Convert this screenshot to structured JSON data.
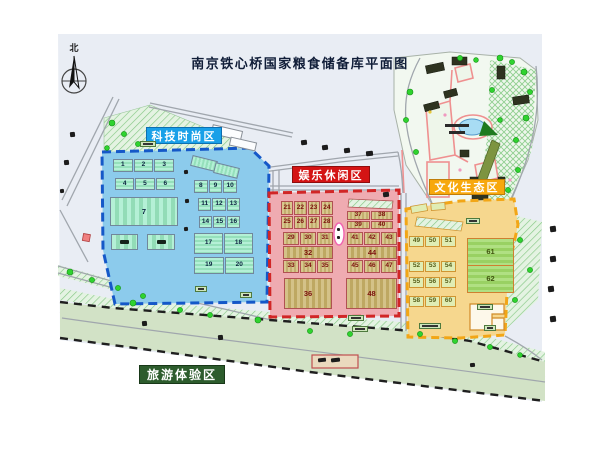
{
  "title": "南京铁心桥国家粮食储备库平面图",
  "compass": {
    "label": "北"
  },
  "zones": {
    "tech": {
      "label": "科技时尚区",
      "accent": "#19a0e8",
      "row1": [
        "1",
        "2",
        "3"
      ],
      "row2": [
        "4",
        "5",
        "6"
      ],
      "big7": "7",
      "row3": [
        "8",
        "9",
        "10"
      ],
      "row4": [
        "11",
        "12",
        "13"
      ],
      "row5": [
        "14",
        "15",
        "16"
      ],
      "pair1": [
        "17",
        "18"
      ],
      "pair2": [
        "19",
        "20"
      ]
    },
    "entertainment": {
      "label": "娱乐休闲区",
      "accent": "#d41414",
      "block_a": [
        "21",
        "22",
        "23",
        "24",
        "25",
        "26",
        "27",
        "28"
      ],
      "block_b": [
        "37",
        "38",
        "39",
        "40"
      ],
      "block_c_top": [
        "29",
        "30",
        "31"
      ],
      "block_c_mid": "32",
      "block_c_bot": [
        "33",
        "34",
        "35"
      ],
      "block_d_top": [
        "41",
        "42",
        "43"
      ],
      "block_d_mid": "44",
      "block_d_bot": [
        "45",
        "46",
        "47"
      ],
      "big_left": "36",
      "big_right": "48"
    },
    "culture": {
      "label": "文化生态区",
      "accent": "#f7a80d",
      "row1": [
        "49",
        "50",
        "51"
      ],
      "row2": [
        "52",
        "53",
        "54"
      ],
      "row3": [
        "55",
        "56",
        "57"
      ],
      "row4": [
        "58",
        "59",
        "60"
      ],
      "big_top": "61",
      "big_bottom": "62"
    },
    "tourism": {
      "label": "旅游体验区",
      "accent": "#2d5c2d"
    }
  },
  "colors": {
    "ground": "#e9edf4",
    "tech_fill": "#8ccbec",
    "tech_dash": "#1558c8",
    "entertainment_fill": "#efabb1",
    "entertainment_dash": "#d12626",
    "culture_fill": "#f6d78e",
    "culture_dash": "#f2a616",
    "tourism_fill": "#d2e2c6",
    "tourism_dash": "#1f1f1f",
    "building_green": "#a5ecca",
    "building_tan": "#c9ba7e",
    "building_lime": "#a8dd77",
    "road": "#a0a6ad",
    "tree": "#2fd32f",
    "pond": "#a8dcf4"
  }
}
